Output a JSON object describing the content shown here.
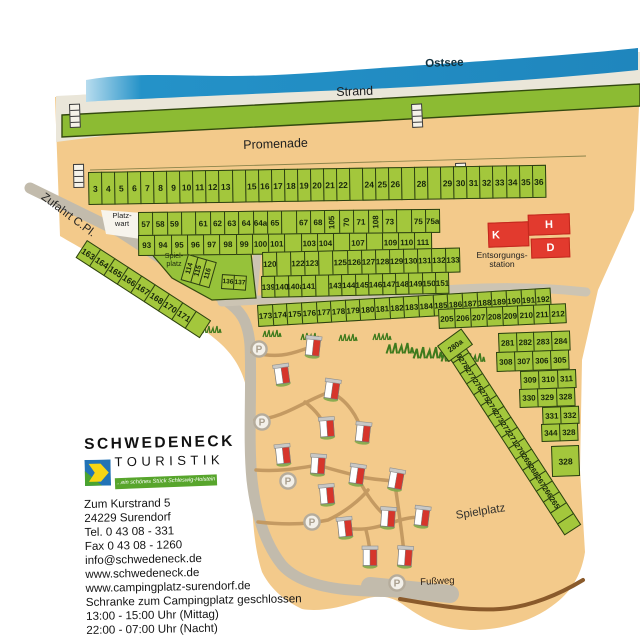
{
  "map": {
    "area_labels": {
      "ostsee": "Ostsee",
      "strand": "Strand",
      "promenade": "Promenade",
      "zufahrt": "Zufahrt C.Pl.",
      "platzwart_line1": "Platz-",
      "platzwart_line2": "wart",
      "spielplatz_small_line1": "Spiel-",
      "spielplatz_small_line2": "platz",
      "entsorgung_line1": "Entsorgungs-",
      "entsorgung_line2": "station",
      "spielplatz_big": "Spielplatz",
      "fussweg": "Fußweg"
    },
    "buildings": [
      {
        "id": "K",
        "label": "K"
      },
      {
        "id": "H",
        "label": "H"
      },
      {
        "id": "D",
        "label": "D"
      }
    ],
    "parking_letter": "P",
    "plot_rows": {
      "r1": [
        "3",
        "4",
        "5",
        "6",
        "7",
        "8",
        "9",
        "10",
        "11",
        "12",
        "13",
        "",
        "15",
        "16",
        "17",
        "18",
        "19",
        "20",
        "21",
        "22",
        "",
        "24",
        "25",
        "26",
        "",
        "28",
        "",
        "29",
        "30",
        "31",
        "32",
        "33",
        "34",
        "35",
        "36"
      ],
      "r2a": [
        "57",
        "58",
        "59",
        "",
        "61",
        "62",
        "63",
        "64",
        "64a",
        "65",
        "",
        "67",
        "68",
        "105",
        "70",
        "71",
        "108",
        "73",
        "",
        "75",
        "75a"
      ],
      "r2b": [
        "93",
        "94",
        "95",
        "96",
        "97",
        "98",
        "99",
        "100",
        "101",
        "",
        "103",
        "104",
        "",
        "107",
        "",
        "109",
        "110",
        "111"
      ],
      "r3a": [
        "120",
        "",
        "122",
        "123",
        "",
        "125",
        "126",
        "127",
        "128",
        "129",
        "130",
        "131",
        "132",
        "133"
      ],
      "r3b": [
        "139",
        "140",
        "140a",
        "141",
        "",
        "143",
        "144",
        "145",
        "146",
        "147",
        "148",
        "149",
        "150",
        "151"
      ],
      "r4": [
        "173",
        "174",
        "175",
        "176",
        "177",
        "178",
        "179",
        "180",
        "181",
        "182",
        "183",
        "184",
        "185",
        "186",
        "187",
        "188",
        "189",
        "190",
        "191",
        "192"
      ],
      "r5": [
        "205",
        "206",
        "207",
        "208",
        "209",
        "210",
        "211",
        "212"
      ],
      "r6a": [
        "281",
        "282",
        "283",
        "284"
      ],
      "r6b": [
        "308",
        "307",
        "306",
        "305"
      ],
      "r7a": [
        "309",
        "310",
        "311"
      ],
      "r7b": [
        "330",
        "329",
        "328"
      ],
      "r8a": [
        "331",
        "332"
      ],
      "r8b": [
        "344",
        "328"
      ],
      "r9": [
        "328"
      ],
      "r10": [
        "279",
        "278",
        "277",
        "276",
        "275",
        "274",
        "273",
        "272",
        "271",
        "270",
        "269",
        "268",
        "267",
        "266",
        "265",
        "",
        ""
      ],
      "r11": [
        "163",
        "164",
        "165",
        "166",
        "167",
        "168",
        "170",
        "171",
        ""
      ],
      "r12": [
        "114",
        "115",
        "116"
      ],
      "r13": [
        "136",
        "137"
      ],
      "r14": [
        "280a"
      ]
    }
  },
  "logo": {
    "line1": "SCHWEDENECK",
    "line2": "TOURISTIK",
    "tagline": "...ein schönes Stück Schleswig-Holstein"
  },
  "contact": {
    "lines": [
      "Zum Kurstrand 5",
      "24229 Surendorf",
      "Tel. 0 43 08 - 331",
      "Fax 0 43 08 - 1260",
      "info@schwedeneck.de",
      "www.schwedeneck.de",
      "www.campingplatz-surendorf.de",
      "Schranke zum Campingplatz geschlossen",
      "13:00 - 15:00 Uhr (Mittag)",
      "22:00 - 07:00 Uhr (Nacht)"
    ]
  },
  "colors": {
    "sand": "#f3ca8b",
    "water": "#2492c8",
    "beach": "#eae6d9",
    "lawn_green": "#8cbb33",
    "plot_green": "#a3c73c",
    "building_red": "#e23a2e",
    "road_gray": "#c2bbac",
    "trail_brown": "#c49a62",
    "footpath_brown": "#8a5a2b",
    "logo_blue": "#2273b6",
    "banner_green": "#57a52c"
  }
}
